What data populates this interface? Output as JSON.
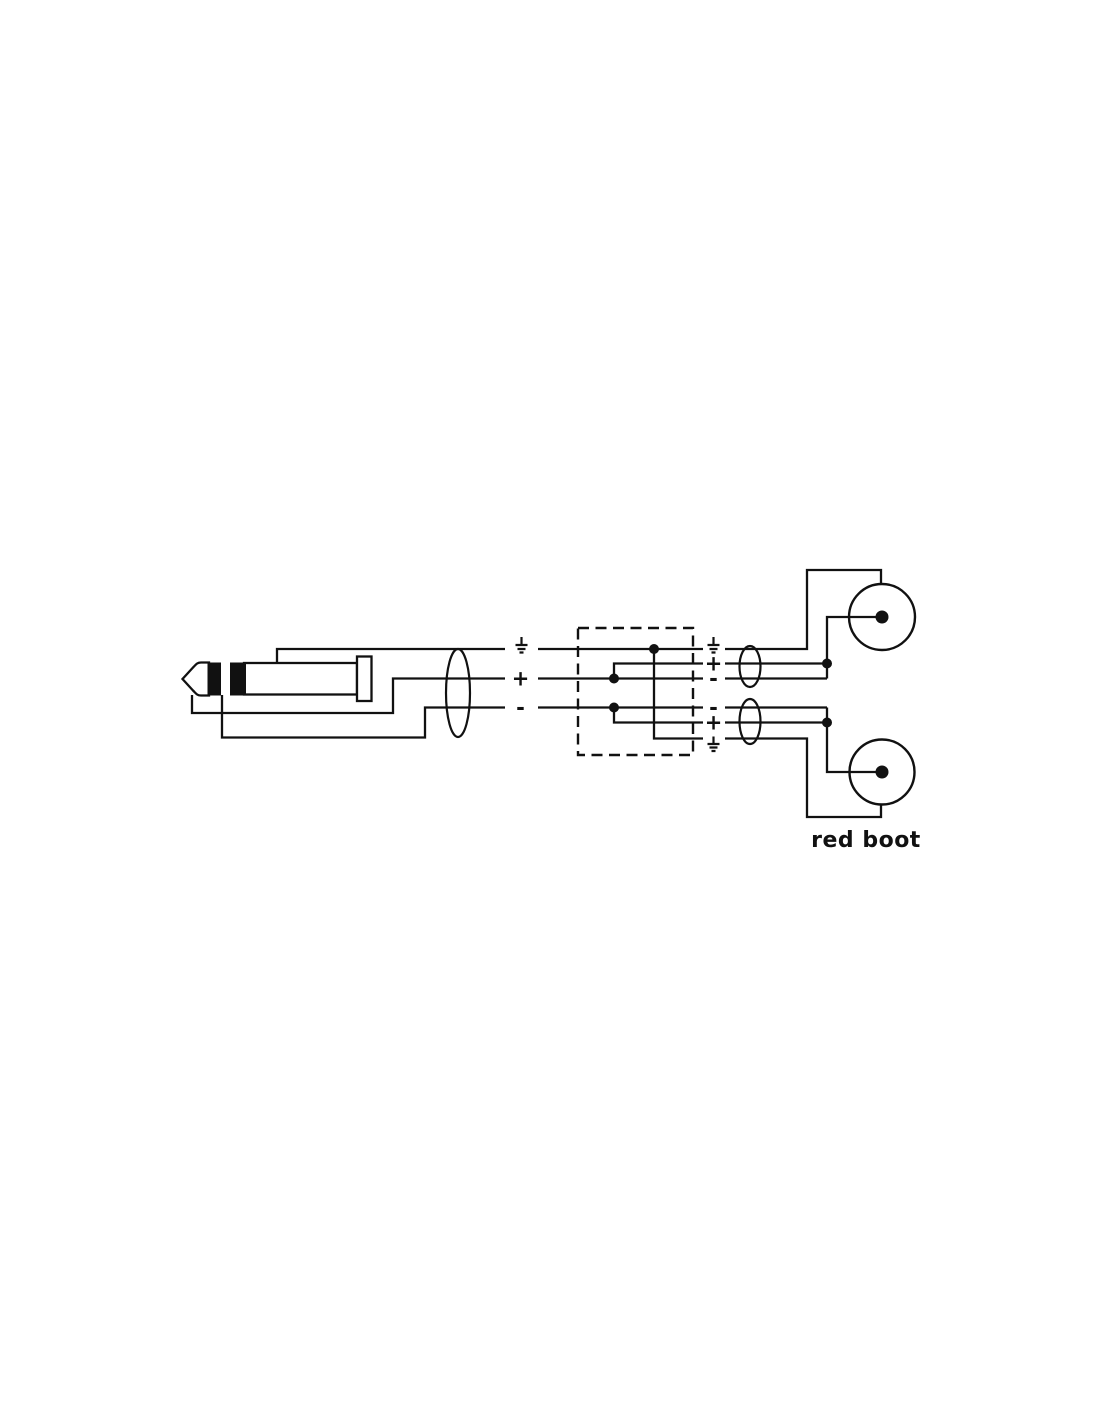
{
  "diagram": {
    "background": "#ffffff",
    "line_color": "#111111",
    "plus": "+",
    "minus": "-",
    "label_red_boot": "red boot",
    "left_connector_terminals": [
      "ground-icon",
      "plus",
      "minus"
    ],
    "top_rca_terminals": [
      "ground-icon",
      "plus",
      "minus"
    ],
    "bottom_rca_terminals": [
      "minus",
      "plus",
      "ground-icon"
    ]
  }
}
